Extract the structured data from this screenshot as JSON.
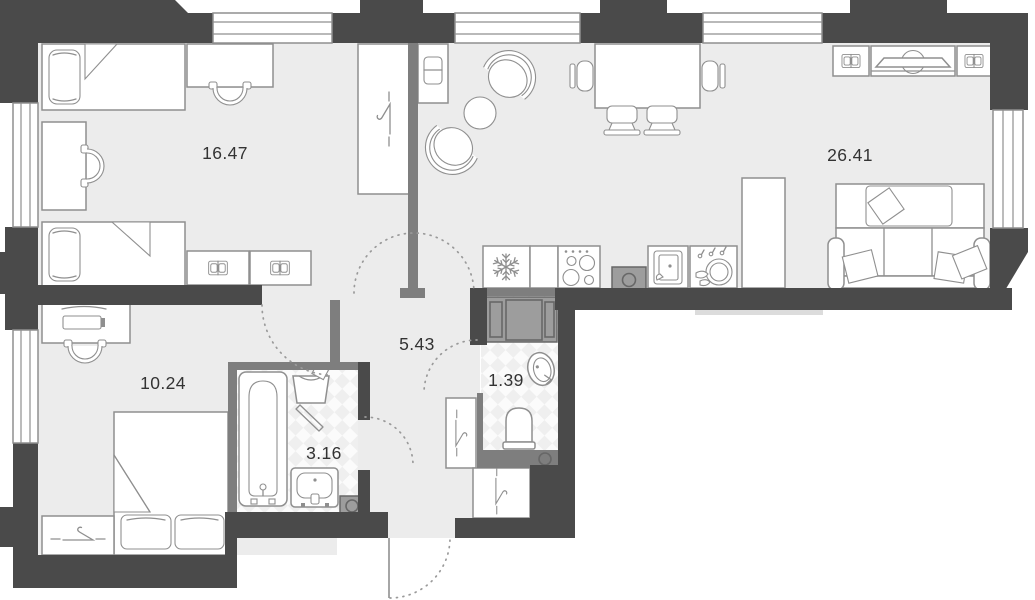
{
  "plan": {
    "kind": "apartment floor plan",
    "rooms": [
      {
        "id": "bedroom-1",
        "area": "16.47"
      },
      {
        "id": "living-kitchen",
        "area": "26.41"
      },
      {
        "id": "bedroom-2",
        "area": "10.24"
      },
      {
        "id": "hallway",
        "area": "5.43"
      },
      {
        "id": "bathroom",
        "area": "3.16"
      },
      {
        "id": "toilet",
        "area": "1.39"
      }
    ],
    "icons": [
      "single-bed",
      "double-bed",
      "pillow",
      "desk",
      "desk-chair",
      "wardrobe-hanger",
      "armchair",
      "coffee-table",
      "dining-table",
      "dining-chair",
      "tv-console",
      "open-book-shelf",
      "sofa",
      "fridge-snowflake",
      "stove-burners",
      "kitchen-sink",
      "dish-rack",
      "washing-machine",
      "laundry-basket",
      "bathtub",
      "wash-basin",
      "toilet-bowl",
      "door-swing-arc",
      "window",
      "shaft"
    ]
  },
  "colors": {
    "wall-dark": "#4a4a4a",
    "wall-partition": "#7e7e7e",
    "floor": "#ececec",
    "line": "#8f8f8f",
    "fixture-gray": "#9d9d9d",
    "fixture-gray-line": "#676767",
    "arc": "#9a9a9a",
    "label": "#333333",
    "wet-a": "#fbfbfb",
    "wet-b": "#efefef",
    "balcony": "#dcdcdc"
  }
}
